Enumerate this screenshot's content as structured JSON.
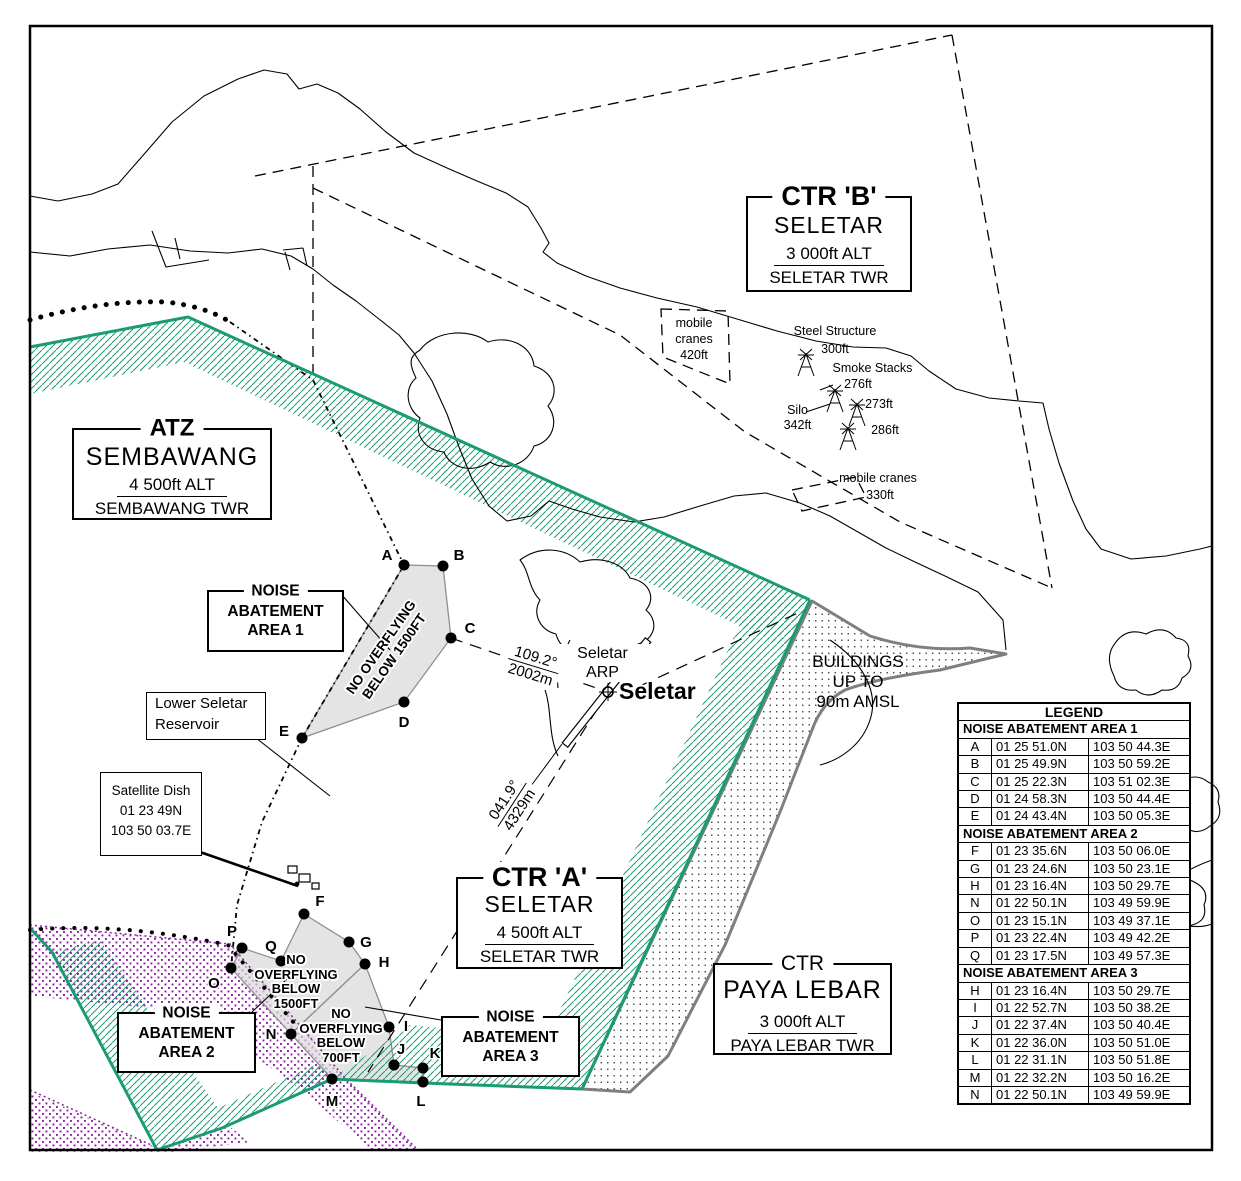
{
  "colors": {
    "teal": "#1A9B73",
    "purple": "#8C1EA0",
    "grey_outline": "#7F7F7F",
    "noise_fill": "#D8D8D8"
  },
  "info_boxes": {
    "ctr_b": {
      "title": "CTR 'B'",
      "name": "SELETAR",
      "alt": "3 000ft ALT",
      "twr": "SELETAR TWR"
    },
    "atz_sembawang": {
      "title": "ATZ",
      "name": "SEMBAWANG",
      "alt": "4 500ft ALT",
      "twr": "SEMBAWANG TWR"
    },
    "ctr_a": {
      "title": "CTR 'A'",
      "name": "SELETAR",
      "alt": "4 500ft ALT",
      "twr": "SELETAR TWR"
    },
    "ctr_paya_lebar": {
      "title": "CTR",
      "name": "PAYA LEBAR",
      "alt": "3 000ft ALT",
      "twr": "PAYA LEBAR TWR"
    }
  },
  "area_boxes": {
    "area1": {
      "title": "NOISE",
      "line1": "ABATEMENT",
      "line2": "AREA 1"
    },
    "area2": {
      "title": "NOISE",
      "line1": "ABATEMENT",
      "line2": "AREA 2"
    },
    "area3": {
      "title": "NOISE",
      "line1": "ABATEMENT",
      "line2": "AREA 3"
    }
  },
  "callouts": {
    "reservoir": {
      "line1": "Lower Seletar",
      "line2": "Reservoir"
    },
    "satellite_dish": {
      "line1": "Satellite Dish",
      "line2": "01 23 49N",
      "line3": "103 50 03.7E"
    },
    "buildings": {
      "line1": "BUILDINGS",
      "line2": "UP TO",
      "line3": "90m AMSL"
    }
  },
  "obstacles": {
    "mobile_cranes_nw": {
      "line1": "mobile",
      "line2": "cranes",
      "line3": "420ft"
    },
    "steel_structure": {
      "label": "Steel Structure",
      "height": "300ft"
    },
    "smoke_stacks": {
      "label": "Smoke Stacks",
      "h1": "276ft",
      "h2": "273ft",
      "h3": "286ft"
    },
    "silo": {
      "label": "Silo",
      "height": "342ft"
    },
    "mobile_cranes_se": {
      "label": "mobile cranes",
      "height": "330ft"
    }
  },
  "airport": {
    "arp_line1": "Seletar",
    "arp_line2": "ARP",
    "city": "Seletar"
  },
  "bearings": {
    "b1": {
      "deg": "109.2°",
      "dist": "2002m"
    },
    "b2": {
      "deg": "041.9°",
      "dist": "4329m"
    }
  },
  "overfly_labels": {
    "area1": {
      "l1": "NO OVERFLYING",
      "l2": "BELOW 1500FT"
    },
    "area2": {
      "l1": "NO",
      "l2": "OVERFLYING",
      "l3": "BELOW",
      "l4": "1500FT"
    },
    "area3": {
      "l1": "NO",
      "l2": "OVERFLYING",
      "l3": "BELOW",
      "l4": "700FT"
    }
  },
  "points": [
    {
      "id": "A",
      "x": 404,
      "y": 565,
      "lx": 387,
      "ly": 560
    },
    {
      "id": "B",
      "x": 443,
      "y": 566,
      "lx": 459,
      "ly": 560
    },
    {
      "id": "C",
      "x": 451,
      "y": 638,
      "lx": 470,
      "ly": 633
    },
    {
      "id": "D",
      "x": 404,
      "y": 702,
      "lx": 404,
      "ly": 727
    },
    {
      "id": "E",
      "x": 302,
      "y": 738,
      "lx": 284,
      "ly": 736
    },
    {
      "id": "F",
      "x": 304,
      "y": 914,
      "lx": 320,
      "ly": 906
    },
    {
      "id": "G",
      "x": 349,
      "y": 942,
      "lx": 366,
      "ly": 947
    },
    {
      "id": "H",
      "x": 365,
      "y": 964,
      "lx": 384,
      "ly": 967
    },
    {
      "id": "I",
      "x": 389,
      "y": 1027,
      "lx": 406,
      "ly": 1031
    },
    {
      "id": "J",
      "x": 394,
      "y": 1065,
      "lx": 401,
      "ly": 1054
    },
    {
      "id": "K",
      "x": 423,
      "y": 1068,
      "lx": 435,
      "ly": 1058
    },
    {
      "id": "L",
      "x": 423,
      "y": 1082,
      "lx": 421,
      "ly": 1106
    },
    {
      "id": "M",
      "x": 332,
      "y": 1079,
      "lx": 332,
      "ly": 1106
    },
    {
      "id": "N",
      "x": 291,
      "y": 1034,
      "lx": 271,
      "ly": 1039
    },
    {
      "id": "O",
      "x": 231,
      "y": 968,
      "lx": 214,
      "ly": 988
    },
    {
      "id": "P",
      "x": 242,
      "y": 948,
      "lx": 232,
      "ly": 936
    },
    {
      "id": "Q",
      "x": 281,
      "y": 961,
      "lx": 271,
      "ly": 951
    }
  ],
  "legend": {
    "title": "LEGEND",
    "sections": [
      {
        "header": "NOISE ABATEMENT AREA 1",
        "rows": [
          [
            "A",
            "01 25 51.0N",
            "103 50 44.3E"
          ],
          [
            "B",
            "01 25 49.9N",
            "103 50 59.2E"
          ],
          [
            "C",
            "01 25 22.3N",
            "103 51 02.3E"
          ],
          [
            "D",
            "01 24 58.3N",
            "103 50 44.4E"
          ],
          [
            "E",
            "01 24 43.4N",
            "103 50 05.3E"
          ]
        ]
      },
      {
        "header": "NOISE ABATEMENT AREA 2",
        "rows": [
          [
            "F",
            "01 23 35.6N",
            "103 50 06.0E"
          ],
          [
            "G",
            "01 23 24.6N",
            "103 50 23.1E"
          ],
          [
            "H",
            "01 23 16.4N",
            "103 50 29.7E"
          ],
          [
            "N",
            "01 22 50.1N",
            "103 49 59.9E"
          ],
          [
            "O",
            "01 23 15.1N",
            "103 49 37.1E"
          ],
          [
            "P",
            "01 23 22.4N",
            "103 49 42.2E"
          ],
          [
            "Q",
            "01 23 17.5N",
            "103 49 57.3E"
          ]
        ]
      },
      {
        "header": "NOISE ABATEMENT AREA 3",
        "rows": [
          [
            "H",
            "01 23 16.4N",
            "103 50 29.7E"
          ],
          [
            "I",
            "01 22 52.7N",
            "103 50 38.2E"
          ],
          [
            "J",
            "01 22 37.4N",
            "103 50 40.4E"
          ],
          [
            "K",
            "01 22 36.0N",
            "103 50 51.0E"
          ],
          [
            "L",
            "01 22 31.1N",
            "103 50 51.8E"
          ],
          [
            "M",
            "01 22 32.2N",
            "103 50 16.2E"
          ],
          [
            "N",
            "01 22 50.1N",
            "103 49 59.9E"
          ]
        ]
      }
    ]
  }
}
